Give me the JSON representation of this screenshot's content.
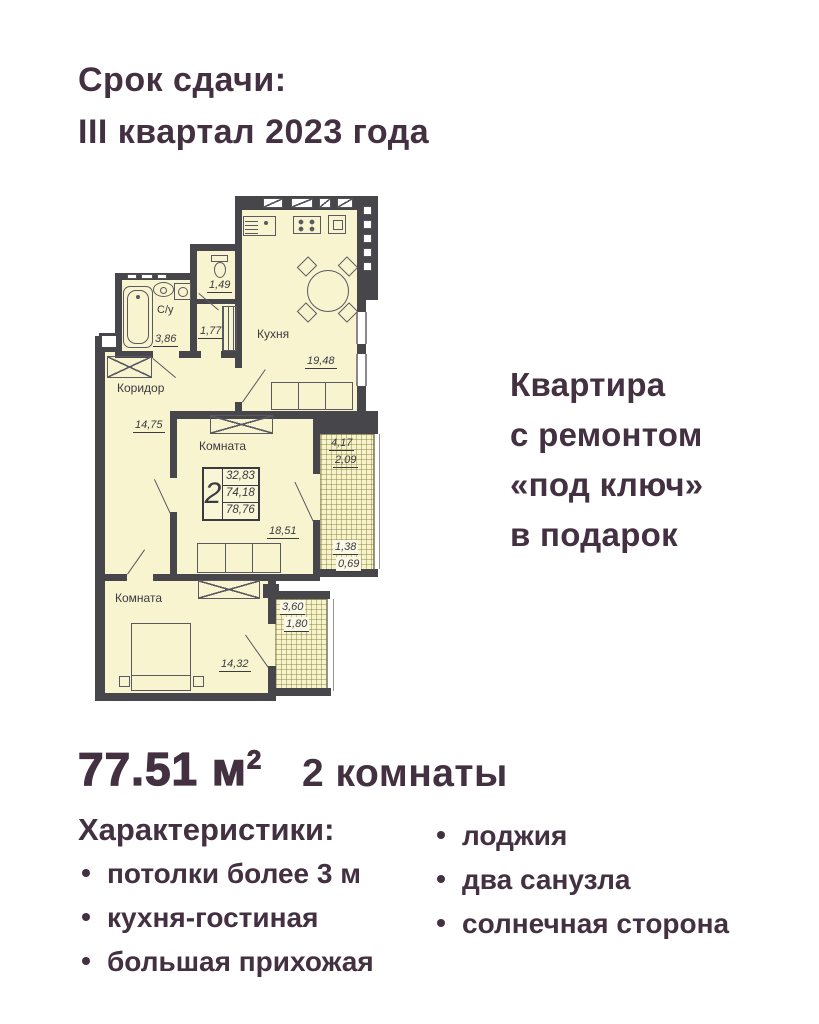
{
  "colors": {
    "accent": "#433041",
    "floor": "#f8f4d0",
    "wall": "#47464b",
    "hatch_line": "#827d3c"
  },
  "header": {
    "line1": "Срок сдачи:",
    "line2": "III квартал 2023 года"
  },
  "promo": {
    "line1": "Квартира",
    "line2": "с ремонтом",
    "line3": "«под ключ»",
    "line4": "в подарок"
  },
  "summary": {
    "area_value": "77.51 м",
    "area_sup": "2",
    "rooms": "2 комнаты"
  },
  "characteristics": {
    "title": "Характеристики:",
    "left": [
      "потолки более 3 м",
      "кухня-гостиная",
      "большая прихожая"
    ],
    "right": [
      "лоджия",
      "два санузла",
      "солнечная сторона"
    ]
  },
  "floorplan": {
    "kitchen": {
      "name": "Кухня",
      "area": "19,48"
    },
    "bathroom": {
      "name": "С/у",
      "area": "3,86"
    },
    "wc": {
      "area": "1,49"
    },
    "closet": {
      "area": "1,77"
    },
    "corridor": {
      "name": "Коридор",
      "area": "14,75"
    },
    "room1": {
      "name": "Комната",
      "area": "18,51"
    },
    "room2": {
      "name": "Комната",
      "area": "14,32"
    },
    "infobox": {
      "rooms": "2",
      "v1": "32,83",
      "v2": "74,18",
      "v3": "78,76"
    },
    "loggia_top": {
      "a": "4,17",
      "b": "2,09"
    },
    "loggia_mid": {
      "a": "1,38",
      "b": "0,69"
    },
    "loggia_bottom": {
      "a": "3,60",
      "b": "1,80"
    }
  }
}
